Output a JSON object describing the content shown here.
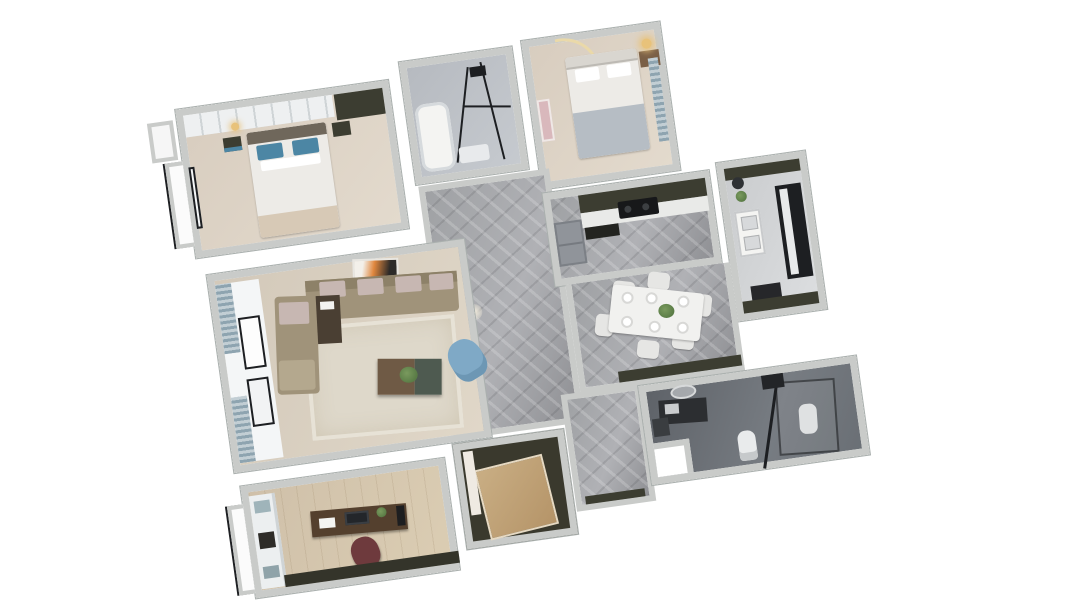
{
  "meta": {
    "content_type": "3d-rendered-floor-plan",
    "view": "axonometric-top-down",
    "plan_rotation_deg": -8,
    "background": "#ffffff",
    "visible_text": "none"
  },
  "palette": {
    "wall": "#c9cbc9",
    "wall_shade": "#aab0ae",
    "floor_bedroom": "#d8cdbf",
    "floor_living": "#d3c9ba",
    "floor_study": "#cfc0a9",
    "floor_marble": "#9fa1a4",
    "floor_bath1": "#b6bac0",
    "floor_bath2": "#5e6268",
    "floor_closet": "#3a392d",
    "closet_wood": "#c9ae84",
    "cabinet_dark": "#3c3d31",
    "counter_white": "#e9eae8",
    "fridge_grey": "#90949a",
    "cooktop_black": "#17181a",
    "bed_white": "#edebe7",
    "headboard_dark": "#6f675b",
    "pillow_blue": "#4c86a4",
    "blanket_tan": "#d7c9b6",
    "blanket_grey": "#b6bdc4",
    "lamp_warm": "#e8c27a",
    "sofa": "#a0937a",
    "sofa_back": "#8d8168",
    "cushion_mauve": "#c7b7b2",
    "side_table": "#4a3f33",
    "armchair_blue": "#7fa9c6",
    "rug": "#ded8ca",
    "ctable_brown": "#6f5a45",
    "ctable_green": "#4e5a50",
    "plant": "#5a7c46",
    "dining_table": "#f1f1ef",
    "chair_white": "#e6e6e4",
    "desk_brown": "#54402e",
    "chair_maroon": "#6e3a3d",
    "curtain_a": "#8ea4b0",
    "curtain_b": "#c2ced4",
    "art_orange": "#e0873e",
    "glass_frame": "#1d1f22",
    "shelf_pink": "#d9b8bc",
    "window_white": "#f4f6f7"
  },
  "rooms": [
    {
      "id": "master-bedroom",
      "name": "master bedroom",
      "furniture": [
        "wardrobe",
        "double-bed-blue-pillows",
        "nightstand-left",
        "nightstand-right",
        "window",
        "bay-window",
        "pendant-light"
      ]
    },
    {
      "id": "bathroom-top",
      "name": "bathroom with shower",
      "furniture": [
        "bathtub",
        "glass-shower-frame",
        "fixtures"
      ]
    },
    {
      "id": "bedroom-2",
      "name": "second bedroom",
      "furniture": [
        "arch-light",
        "double-bed-white",
        "nightstand-lamp",
        "pink-shelf",
        "curtain"
      ]
    },
    {
      "id": "kitchen",
      "name": "kitchen",
      "furniture": [
        "upper-cabinets",
        "counter",
        "gas-cooktop",
        "refrigerator",
        "range-hood"
      ]
    },
    {
      "id": "utility-balcony",
      "name": "utility balcony",
      "furniture": [
        "double-sink",
        "dark-window",
        "plant",
        "cabinet-strip"
      ]
    },
    {
      "id": "dining-area",
      "name": "dining area",
      "furniture": [
        "dining-table",
        "chairs-x6",
        "plates-x6",
        "centerpiece-plant",
        "sideboard"
      ]
    },
    {
      "id": "hallway",
      "name": "marble hallway",
      "furniture": []
    },
    {
      "id": "living-room",
      "name": "living room",
      "furniture": [
        "sectional-sofa",
        "cushions",
        "side-table",
        "coffee-table",
        "plant",
        "blue-armchair",
        "rug",
        "artwork-orange",
        "balcony-curtains",
        "windows"
      ]
    },
    {
      "id": "study",
      "name": "study",
      "furniture": [
        "desk",
        "monitor",
        "maroon-office-chair",
        "bookshelf",
        "low-bookcase",
        "bay-window"
      ]
    },
    {
      "id": "closet-room",
      "name": "walk-in closet / storage",
      "furniture": [
        "wood-wardrobe-panel"
      ]
    },
    {
      "id": "bathroom-bottom",
      "name": "dark-tiled bathroom",
      "furniture": [
        "vanity",
        "round-mirror",
        "toilet",
        "second-fixture",
        "glass-shower",
        "towel-fixtures"
      ]
    }
  ],
  "counts": {
    "rooms": 11,
    "dining_chairs": 6,
    "dining_plates": 6
  }
}
